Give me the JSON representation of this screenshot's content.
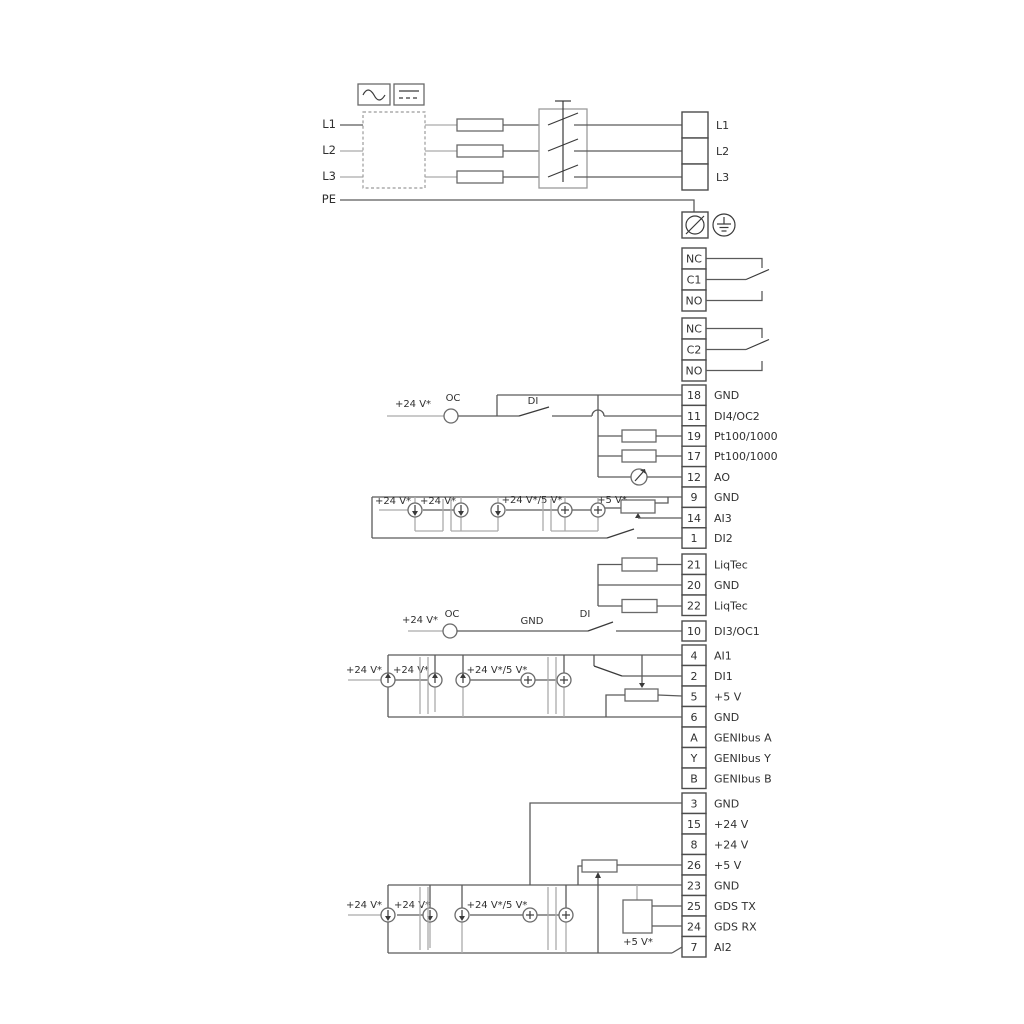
{
  "colors": {
    "wire": "#5a5a5a",
    "wire_gray": "#aaaaaa",
    "text": "#303030",
    "background": "#ffffff"
  },
  "power": {
    "in": [
      "L1",
      "L2",
      "L3",
      "PE"
    ],
    "out": [
      "L1",
      "L2",
      "L3"
    ]
  },
  "relays": {
    "r1": [
      "NC",
      "C1",
      "NO"
    ],
    "r2": [
      "NC",
      "C2",
      "NO"
    ]
  },
  "io1": {
    "rows": [
      {
        "num": "18",
        "label": "GND"
      },
      {
        "num": "11",
        "label": "DI4/OC2"
      },
      {
        "num": "19",
        "label": "Pt100/1000"
      },
      {
        "num": "17",
        "label": "Pt100/1000"
      },
      {
        "num": "12",
        "label": "AO"
      },
      {
        "num": "9",
        "label": "GND"
      },
      {
        "num": "14",
        "label": "AI3"
      },
      {
        "num": "1",
        "label": "DI2"
      }
    ]
  },
  "liqtec": {
    "rows": [
      {
        "num": "21",
        "label": "LiqTec"
      },
      {
        "num": "20",
        "label": "GND"
      },
      {
        "num": "22",
        "label": "LiqTec"
      }
    ]
  },
  "io2": {
    "rows": [
      {
        "num": "10",
        "label": "DI3/OC1"
      },
      {
        "num": "4",
        "label": "AI1"
      },
      {
        "num": "2",
        "label": "DI1"
      },
      {
        "num": "5",
        "label": "+5 V"
      },
      {
        "num": "6",
        "label": "GND"
      },
      {
        "num": "A",
        "label": "GENIbus A"
      },
      {
        "num": "Y",
        "label": "GENIbus Y"
      },
      {
        "num": "B",
        "label": "GENIbus B"
      }
    ]
  },
  "io3": {
    "rows": [
      {
        "num": "3",
        "label": "GND"
      },
      {
        "num": "15",
        "label": "+24 V"
      },
      {
        "num": "8",
        "label": "+24 V"
      },
      {
        "num": "26",
        "label": "+5 V"
      },
      {
        "num": "23",
        "label": "GND"
      },
      {
        "num": "25",
        "label": "GDS TX"
      },
      {
        "num": "24",
        "label": "GDS RX"
      },
      {
        "num": "7",
        "label": "AI2"
      }
    ]
  },
  "ann": {
    "di4": {
      "v24": "+24 V*",
      "oc": "OC",
      "di": "DI"
    },
    "ai3": {
      "v24a": "+24 V*",
      "v24b": "+24 V*",
      "v24_5": "+24 V*/5 V*",
      "v5": "+5 V*"
    },
    "di3": {
      "v24": "+24 V*",
      "oc": "OC",
      "gnd": "GND",
      "di": "DI"
    },
    "ai1": {
      "v24a": "+24 V*",
      "v24b": "+24 V*",
      "v24_5": "+24 V*/5 V*"
    },
    "ai2": {
      "v24a": "+24 V*",
      "v24b": "+24 V*",
      "v24_5": "+24 V*/5 V*",
      "v5": "+5 V*"
    }
  }
}
